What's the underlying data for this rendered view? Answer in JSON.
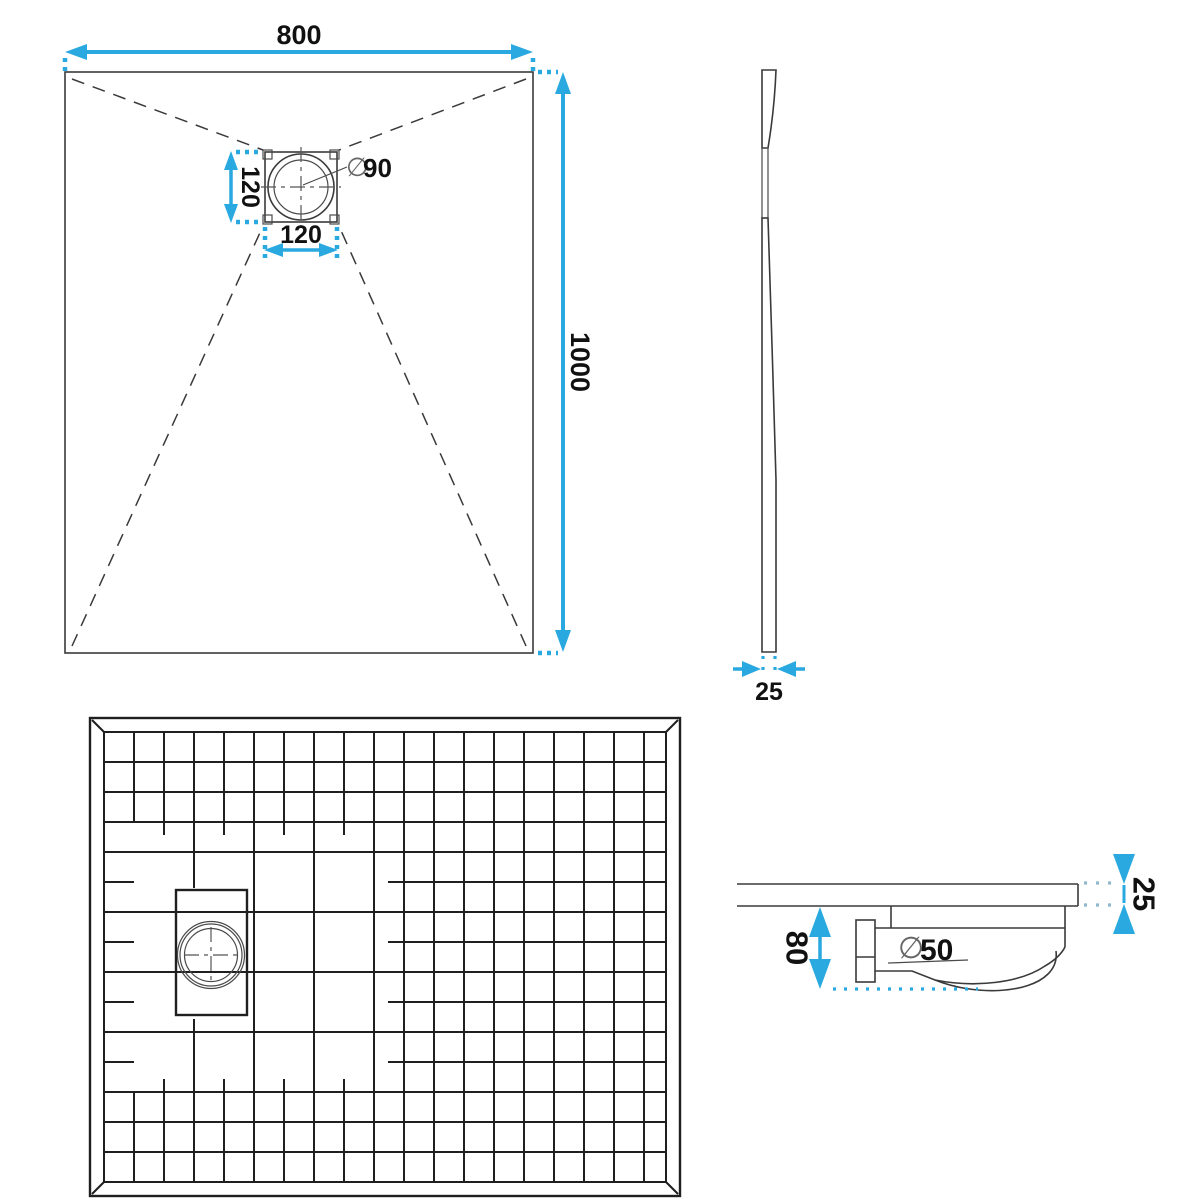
{
  "colors": {
    "dimension_accent": "#29A9E0",
    "muted_dots": "#8FB9CC",
    "drawing_lines": "#3A3A3A",
    "text": "#111111"
  },
  "views": {
    "top_view": {
      "width_mm": "800",
      "length_mm": "1000",
      "drain_offset_vertical_mm": "120",
      "drain_offset_horizontal_mm": "120",
      "diameter_symbol": "∅",
      "drain_diameter_mm": "90"
    },
    "side_view": {
      "thickness_mm": "25"
    },
    "section_view": {
      "thickness_mm": "25",
      "drain_depth_mm": "80",
      "diameter_symbol": "∅",
      "waste_diameter_mm": "50"
    }
  }
}
